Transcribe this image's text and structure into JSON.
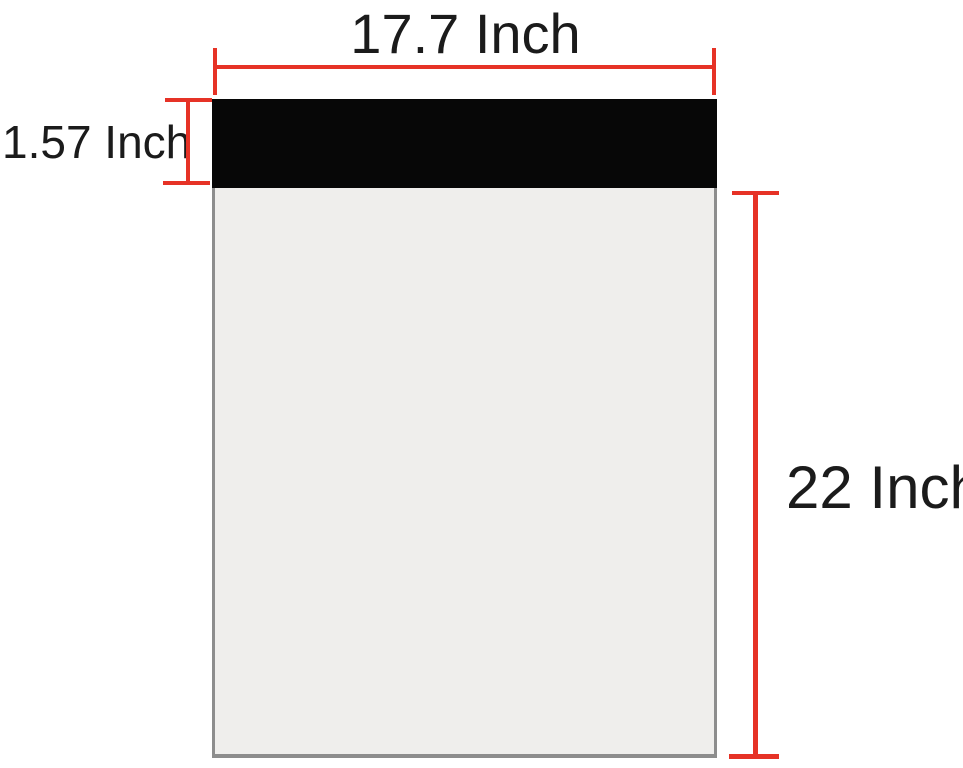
{
  "diagram": {
    "width_label": "17.7 Inch",
    "flap_height_label": "1.57 Inch",
    "body_height_label": "22 Inch",
    "colors": {
      "dimension": "#e63226",
      "flap": "#070707",
      "body_fill": "#efeeec",
      "body_border": "#8d8d8d",
      "text": "#1b1b1b",
      "background": "#ffffff"
    }
  }
}
